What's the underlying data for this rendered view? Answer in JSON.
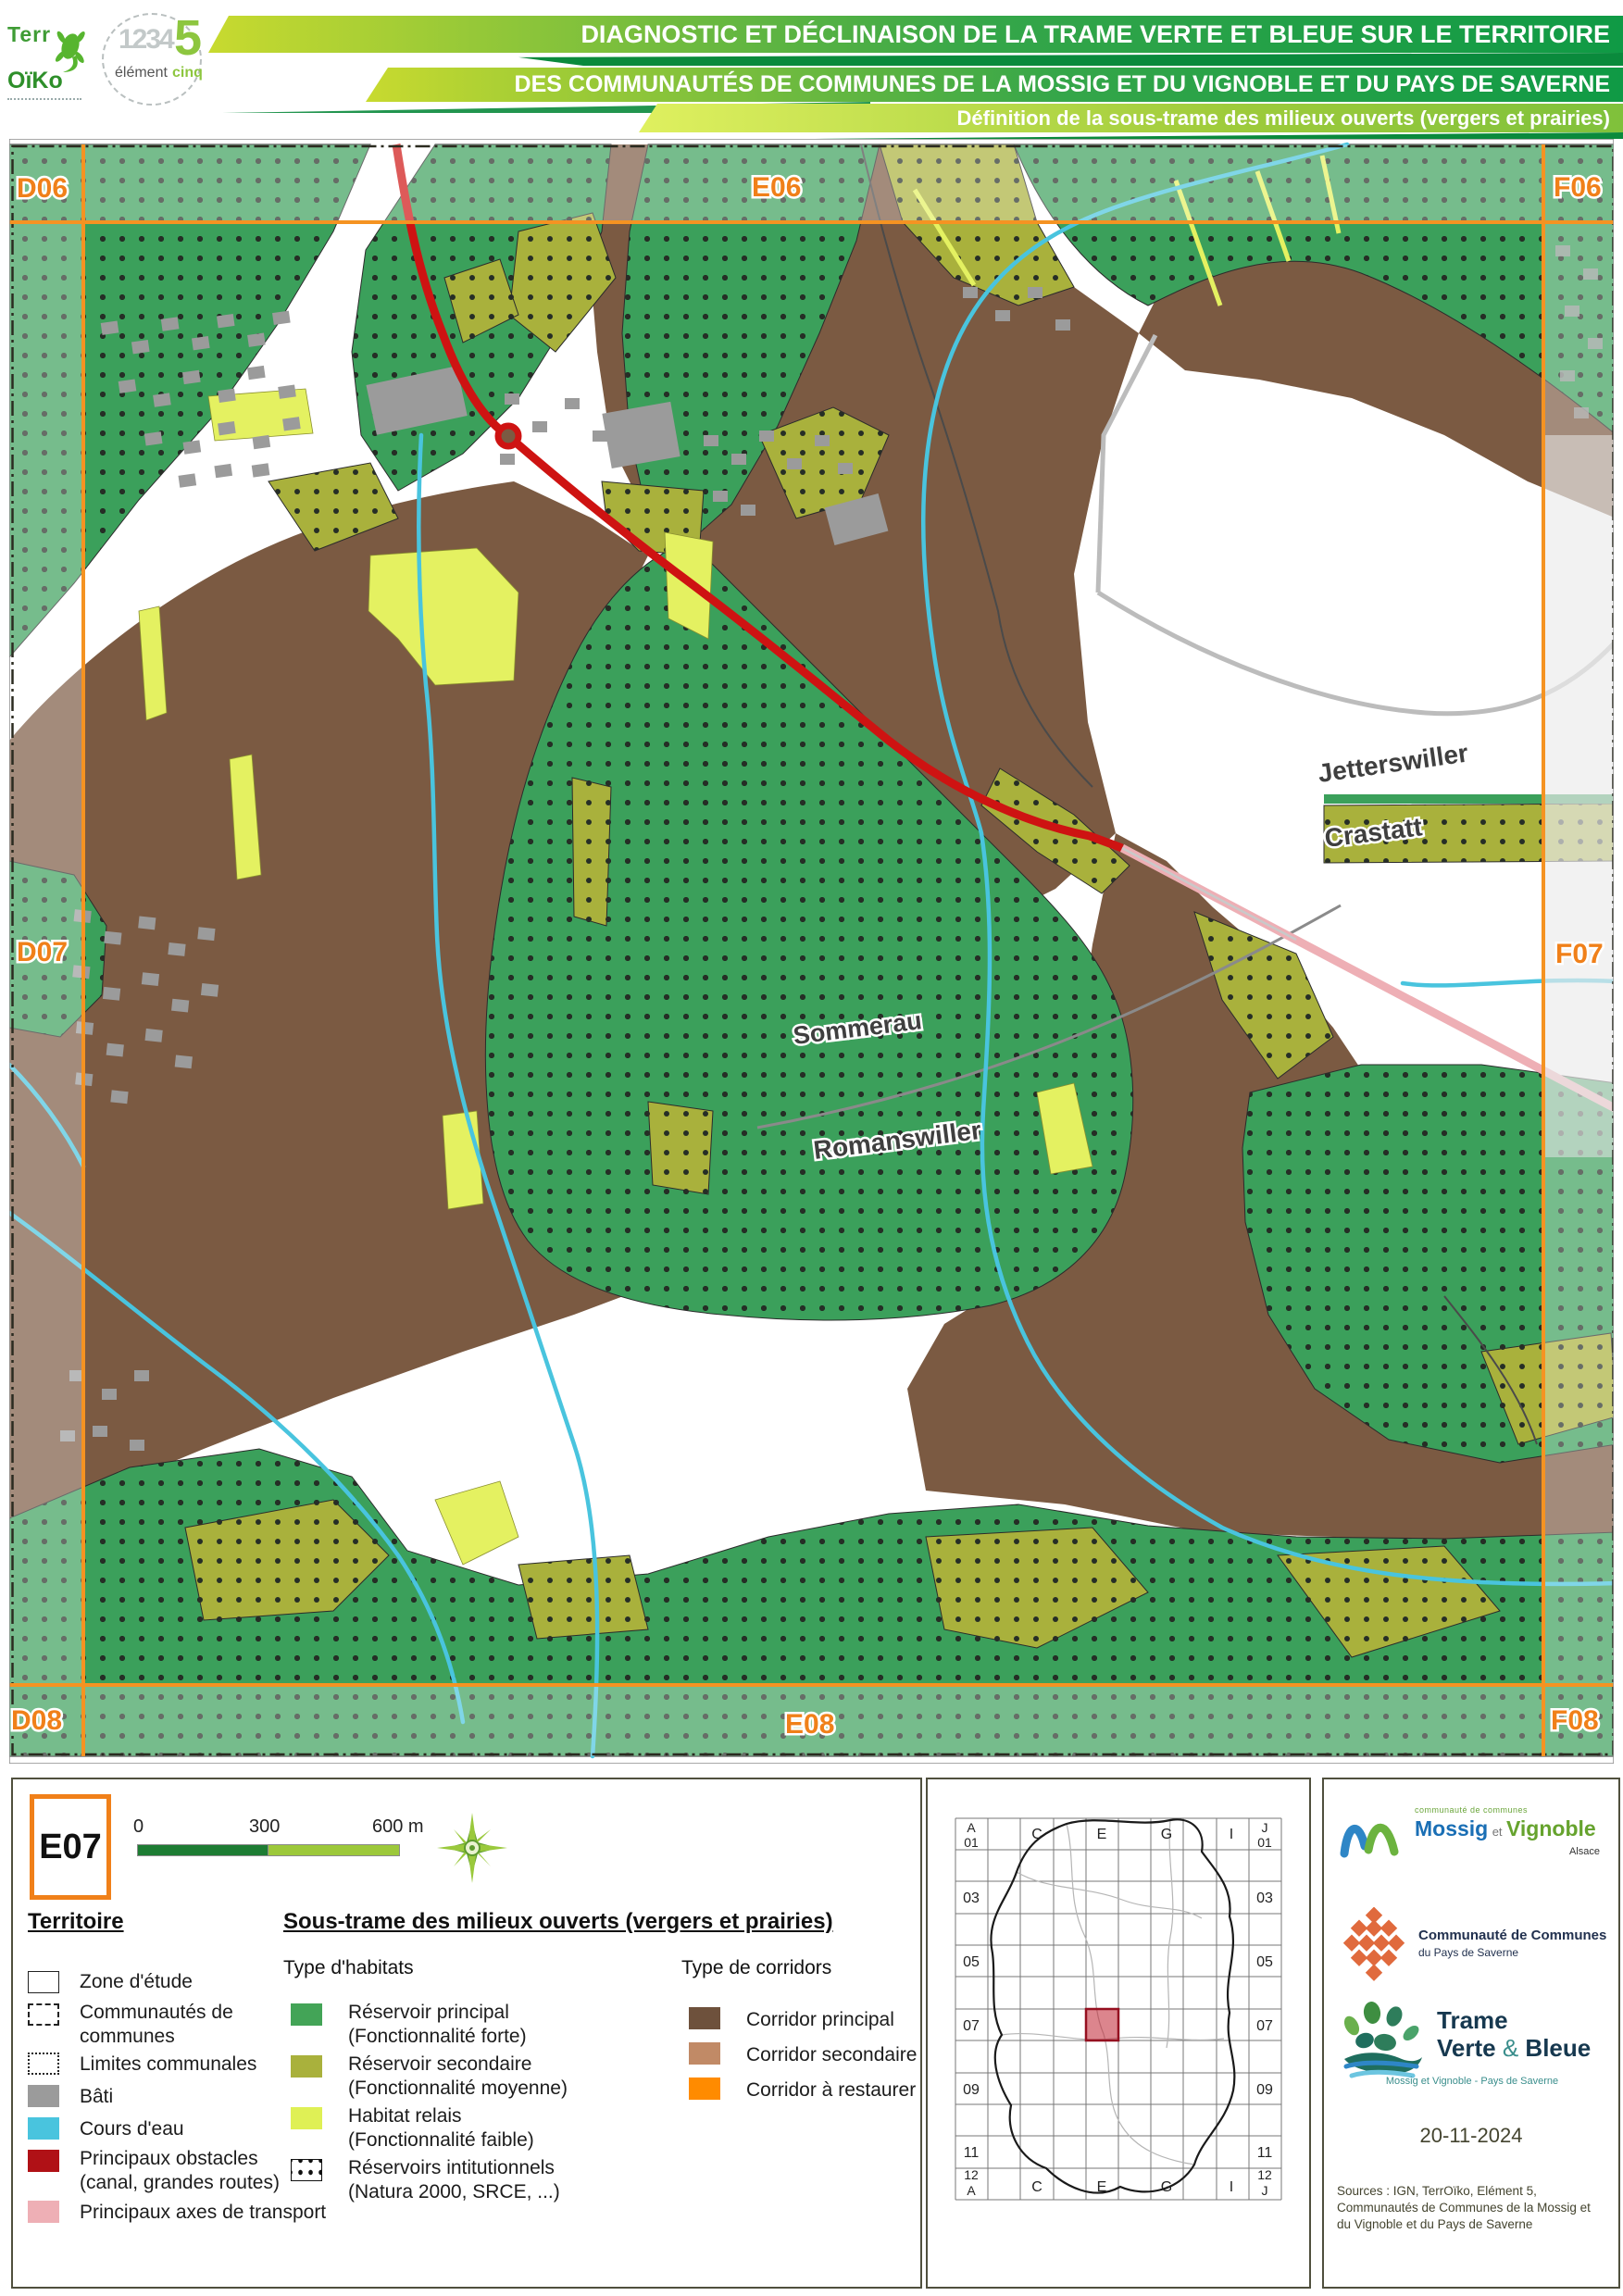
{
  "header": {
    "banner_line1": "DIAGNOSTIC ET DÉCLINAISON DE LA TRAME VERTE ET BLEUE SUR LE TERRITOIRE",
    "banner_line2": "DES COMMUNAUTÉS DE COMMUNES DE LA MOSSIG ET DU VIGNOBLE ET DU PAYS DE SAVERNE",
    "banner_line3": "Définition de la sous-trame des milieux ouverts (vergers et prairies)",
    "terroiko_logo": {
      "word1": "Terr",
      "word2": "OïKo"
    },
    "element5_logo": {
      "digits": "1234",
      "five": "5",
      "word1": "élément",
      "word2": "cinq"
    }
  },
  "map": {
    "tile_labels": {
      "d06": "D06",
      "e06": "E06",
      "f06": "F06",
      "d07": "D07",
      "f07": "F07",
      "d08": "D08",
      "e08": "E08",
      "f08": "F08"
    },
    "place_labels": {
      "jetterswiller": "Jetterswiller",
      "crastatt": "Crastatt",
      "sommerau": "Sommerau",
      "romanswiller": "Romanswiller"
    }
  },
  "map_key": {
    "tile_id": "E07"
  },
  "scalebar": {
    "tick0": "0",
    "tick300": "300",
    "tick600": "600 m"
  },
  "legend": {
    "territoire": {
      "title": "Territoire",
      "items": [
        {
          "label": "Zone d'étude"
        },
        {
          "label": "Communautés de",
          "label2": "communes"
        },
        {
          "label": "Limites communales"
        },
        {
          "label": "Bâti"
        },
        {
          "label": "Cours d'eau"
        },
        {
          "label": "Principaux obstacles",
          "label2": "(canal, grandes routes)"
        },
        {
          "label": "Principaux axes de transport"
        }
      ]
    },
    "soustrame": {
      "title": "Sous-trame des milieux ouverts (vergers et prairies)",
      "habitats_title": "Type d'habitats",
      "habitats": [
        {
          "label": "Réservoir principal",
          "label2": "(Fonctionnalité forte)"
        },
        {
          "label": "Réservoir secondaire",
          "label2": "(Fonctionnalité moyenne)"
        },
        {
          "label": "Habitat relais",
          "label2": "(Fonctionnalité faible)"
        },
        {
          "label": "Réservoirs intitutionnels",
          "label2": "(Natura 2000, SRCE, ...)"
        }
      ],
      "corridors_title": "Type de corridors",
      "corridors": [
        {
          "label": "Corridor principal"
        },
        {
          "label": "Corridor secondaire"
        },
        {
          "label": "Corridor à restaurer"
        }
      ]
    }
  },
  "inset": {
    "corner_top_left": "A",
    "corner_top_right": "J",
    "first_row": "01",
    "row_numbers": [
      "03",
      "05",
      "07",
      "09",
      "11"
    ],
    "last_row": "12",
    "last_left": "A",
    "last_right": "J",
    "col_letters": [
      "C",
      "E",
      "G",
      "I"
    ],
    "highlight_cell": "E07"
  },
  "logos_panel": {
    "mossig": {
      "small": "communauté de communes",
      "name1": "Mossig",
      "et": "et",
      "name2": "Vignoble",
      "region": "Alsace"
    },
    "saverne": {
      "line1": "Communauté de Communes",
      "line2": "du Pays de Saverne"
    },
    "tvb": {
      "word1": "Trame",
      "word2": "Verte",
      "amp": "&",
      "word3": "Bleue",
      "subtitle": "Mossig et Vignoble - Pays de Saverne"
    },
    "date": "20-11-2024",
    "sources": "Sources : IGN, TerrOïko, Elément 5, Communautés de Communes de la Mossig et du Vignoble et du Pays de Saverne"
  },
  "colors": {
    "reservoir_principal": "#3ba05b",
    "reservoir_secondaire": "#a9b13c",
    "habitat_relais": "#e4f161",
    "corridor_principal": "#7b5a42",
    "corridor_secondaire": "#c18a66",
    "corridor_restaurer": "#ff8b00",
    "bati": "#9b9b9b",
    "cours_eau": "#49c4de",
    "obstacles": "#b01116",
    "axes_transport": "#eeafb5",
    "grid_orange": "#f59322"
  }
}
